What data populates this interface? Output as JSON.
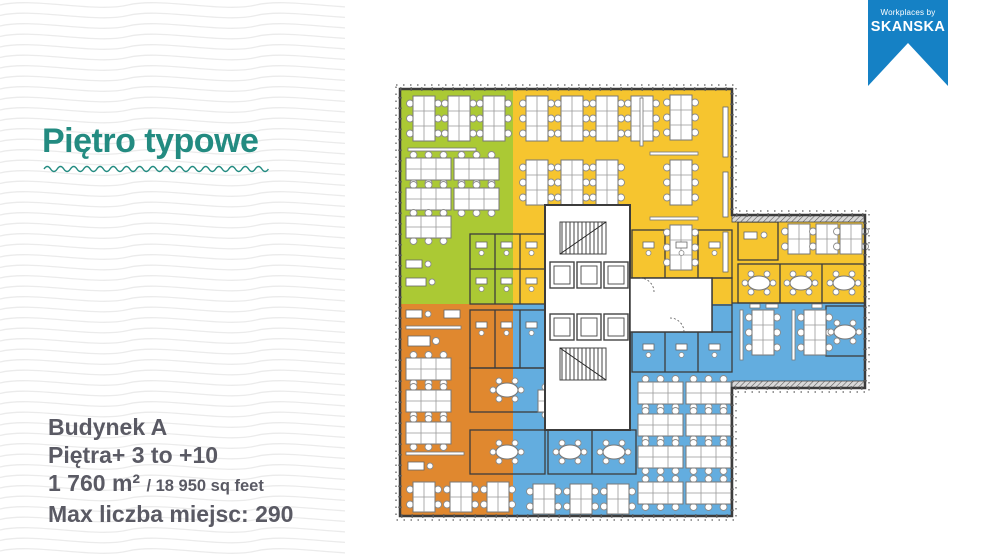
{
  "title": "Piętro typowe",
  "specs": {
    "building": "Budynek A",
    "floors": "Piętra+ 3 to +10",
    "area_metric": "1 760 m²",
    "area_imperial": "/ 18 950 sq feet",
    "capacity": "Max liczba miejsc: 290"
  },
  "ribbon": {
    "tagline": "Workplaces by",
    "brand": "SKANSKA",
    "color": "#1581C5"
  },
  "floorplan": {
    "zones": [
      {
        "name": "open-space-green",
        "color": "#ABC934"
      },
      {
        "name": "open-space-yellow",
        "color": "#F6C52F"
      },
      {
        "name": "open-space-orange",
        "color": "#E0882F"
      },
      {
        "name": "open-space-blue",
        "color": "#63ADDF"
      }
    ],
    "wall_color": "#3C3C3C",
    "title_color": "#238B81",
    "text_color": "#5A5A64"
  }
}
